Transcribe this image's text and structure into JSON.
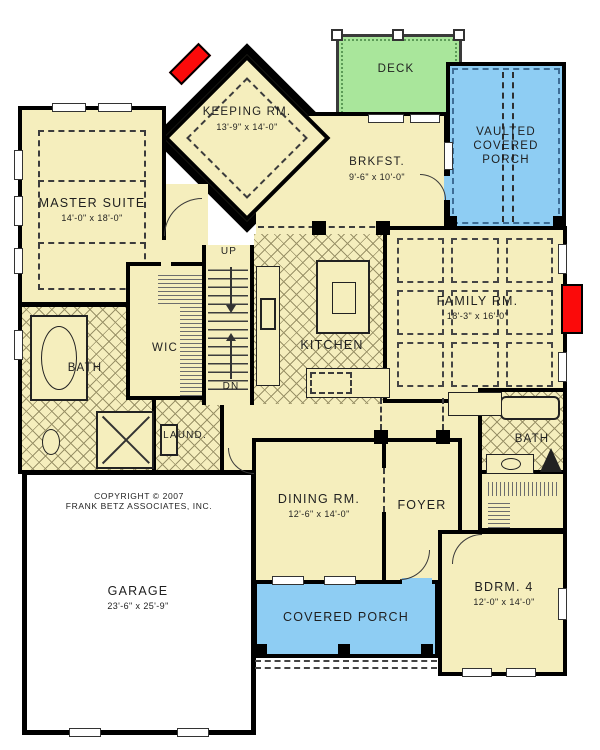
{
  "colors": {
    "cream": "#F5EEBD",
    "hatch_line": "#9A9268",
    "porch_blue": "#8ECDF3",
    "deck_green": "#A9E69B",
    "fire_red": "#FB0A0A",
    "wall": "#000000",
    "ink": "#1F1F1F"
  },
  "rooms": {
    "deck": {
      "name": "DECK"
    },
    "vaulted_porch": {
      "name": "VAULTED COVERED PORCH"
    },
    "keeping": {
      "name": "KEEPING RM.",
      "dims": "13'-9\" x 14'-0\""
    },
    "brkfst": {
      "name": "BRKFST.",
      "dims": "9'-6\" x 10'-0\""
    },
    "master": {
      "name": "MASTER SUITE",
      "dims": "14'-0\" x 18'-0\""
    },
    "family": {
      "name": "FAMILY RM.",
      "dims": "18'-3\" x 16'-0\""
    },
    "bath1": {
      "name": "BATH"
    },
    "wic": {
      "name": "WIC"
    },
    "kitchen": {
      "name": "KITCHEN"
    },
    "laundry": {
      "name": "LAUND."
    },
    "dining": {
      "name": "DINING RM.",
      "dims": "12'-6\" x 14'-0\""
    },
    "foyer": {
      "name": "FOYER"
    },
    "bath2": {
      "name": "BATH"
    },
    "garage": {
      "name": "GARAGE",
      "dims": "23'-6\" x 25'-9\""
    },
    "covered_porch": {
      "name": "COVERED PORCH"
    },
    "bdrm4": {
      "name": "BDRM. 4",
      "dims": "12'-0\" x 14'-0\""
    }
  },
  "stairs": {
    "up": "UP",
    "dn": "DN"
  },
  "copyright": {
    "line1": "COPYRIGHT © 2007",
    "line2": "FRANK BETZ ASSOCIATES, INC."
  }
}
